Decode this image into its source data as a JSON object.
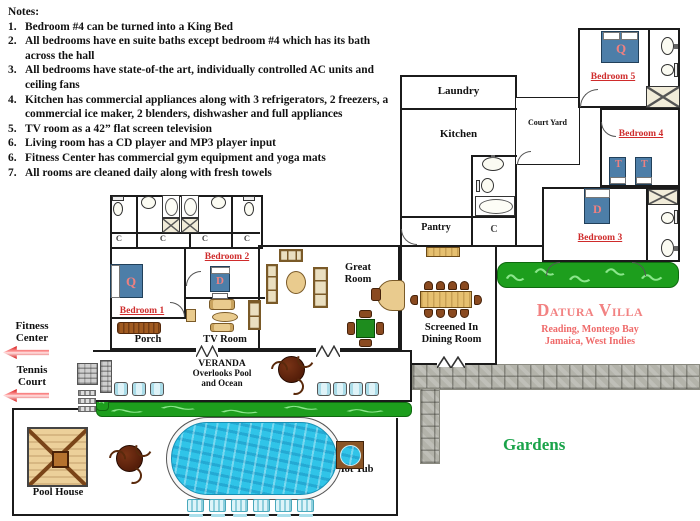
{
  "notes": {
    "heading": "Notes:",
    "items": [
      {
        "num": "1.",
        "text": "Bedroom #4 can be turned into a King Bed"
      },
      {
        "num": "2.",
        "text": "All bedrooms have en suite baths except bedroom #4 which has its bath across the hall"
      },
      {
        "num": "3.",
        "text": "All bedrooms have state-of-the art, individually controlled AC units and ceiling fans"
      },
      {
        "num": "4.",
        "text": "Kitchen has commercial appliances along with 3 refrigerators, 2 freezers, a commercial ice maker, 2 blenders, dishwasher and full appliances"
      },
      {
        "num": "5.",
        "text": "TV room as a 42” flat screen television"
      },
      {
        "num": "6.",
        "text": "Living room has a CD player and MP3 player input"
      },
      {
        "num": "6.",
        "text": "Fitness Center has commercial gym equipment and yoga mats"
      },
      {
        "num": "7.",
        "text": "All rooms are cleaned daily along with fresh towels"
      }
    ]
  },
  "villa": {
    "name": "Datura Villa",
    "address_line1": "Reading, Montego Bay",
    "address_line2": "Jamaica, West Indies"
  },
  "rooms": {
    "laundry": "Laundry",
    "kitchen": "Kitchen",
    "pantry": "Pantry",
    "courtyard": "Court Yard",
    "bedroom1": "Bedroom 1",
    "bedroom2": "Bedroom 2",
    "bedroom3": "Bedroom 3",
    "bedroom4": "Bedroom 4",
    "bedroom5": "Bedroom 5",
    "porch": "Porch",
    "tv_room": "TV Room",
    "great_room_line1": "Great",
    "great_room_line2": "Room",
    "dining_line1": "Screened In",
    "dining_line2": "Dining Room",
    "veranda_line1": "VERANDA",
    "veranda_line2": "Overlooks Pool",
    "veranda_line3": "and Ocean",
    "hot_tub": "Hot Tub",
    "pool_house": "Pool House",
    "gardens": "Gardens"
  },
  "beds": {
    "bedroom1": "Q",
    "bedroom2": "D",
    "bedroom3": "D",
    "bedroom4a": "T",
    "bedroom4b": "T",
    "bedroom5": "Q"
  },
  "closet_label": "C",
  "signs": {
    "fitness_line1": "Fitness",
    "fitness_line2": "Center",
    "tennis_line1": "Tennis",
    "tennis_line2": "Court"
  },
  "colors": {
    "bed_blue": "#4d7ea8",
    "room_label_red": "#cf2b2b",
    "bed_letter_pink": "#ef8080",
    "villa_title_pink": "#f28282",
    "hedge_green": "#1d9e1d",
    "gardens_green": "#1aa34a",
    "pool_blue": "#30c4e8",
    "stone_gray": "#b3b3aa",
    "wood_tan": "#e9cb8e",
    "arrow_red": "#d51111"
  }
}
